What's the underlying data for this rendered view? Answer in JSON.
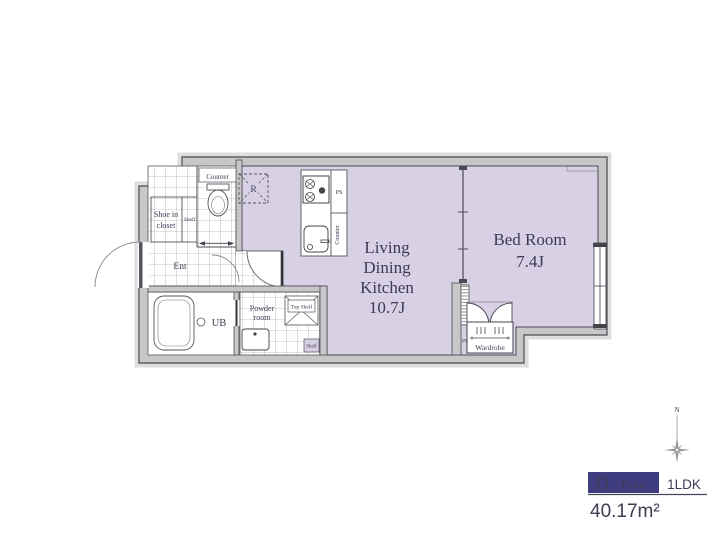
{
  "colors": {
    "floor": "#d8d0e4",
    "wall": "#c7c7c7",
    "wall_shadow": "#dedede",
    "line": "#4a4a55",
    "accent": "#3f3d80",
    "ink": "#3c3c52",
    "legend_ink": "#2c2c50"
  },
  "plan": {
    "labels": {
      "counter_top": "Counter",
      "shoe1": "Shoe in",
      "shoe2": "closet",
      "shelf_entry": "Shelf",
      "ent": "Ent",
      "fridge": "R",
      "ps_kitchen": "PS",
      "counter_kitchen": "Counter",
      "ub": "UB",
      "powder1": "Powder",
      "powder2": "room",
      "top_shelf": "Top Shelf",
      "shelf_powder": "Shelf",
      "ps_wardrobe": "PS",
      "wardrobe": "Wardrobe"
    },
    "rooms": {
      "ldk": [
        "Living",
        "Dining",
        "Kitchen",
        "10.7J"
      ],
      "bedroom": [
        "Bed Room",
        "7.4J"
      ]
    }
  },
  "legend": {
    "north": "N",
    "type_letter": "D",
    "type_word": "Type",
    "layout": "1LDK",
    "area": "40.17m²"
  }
}
